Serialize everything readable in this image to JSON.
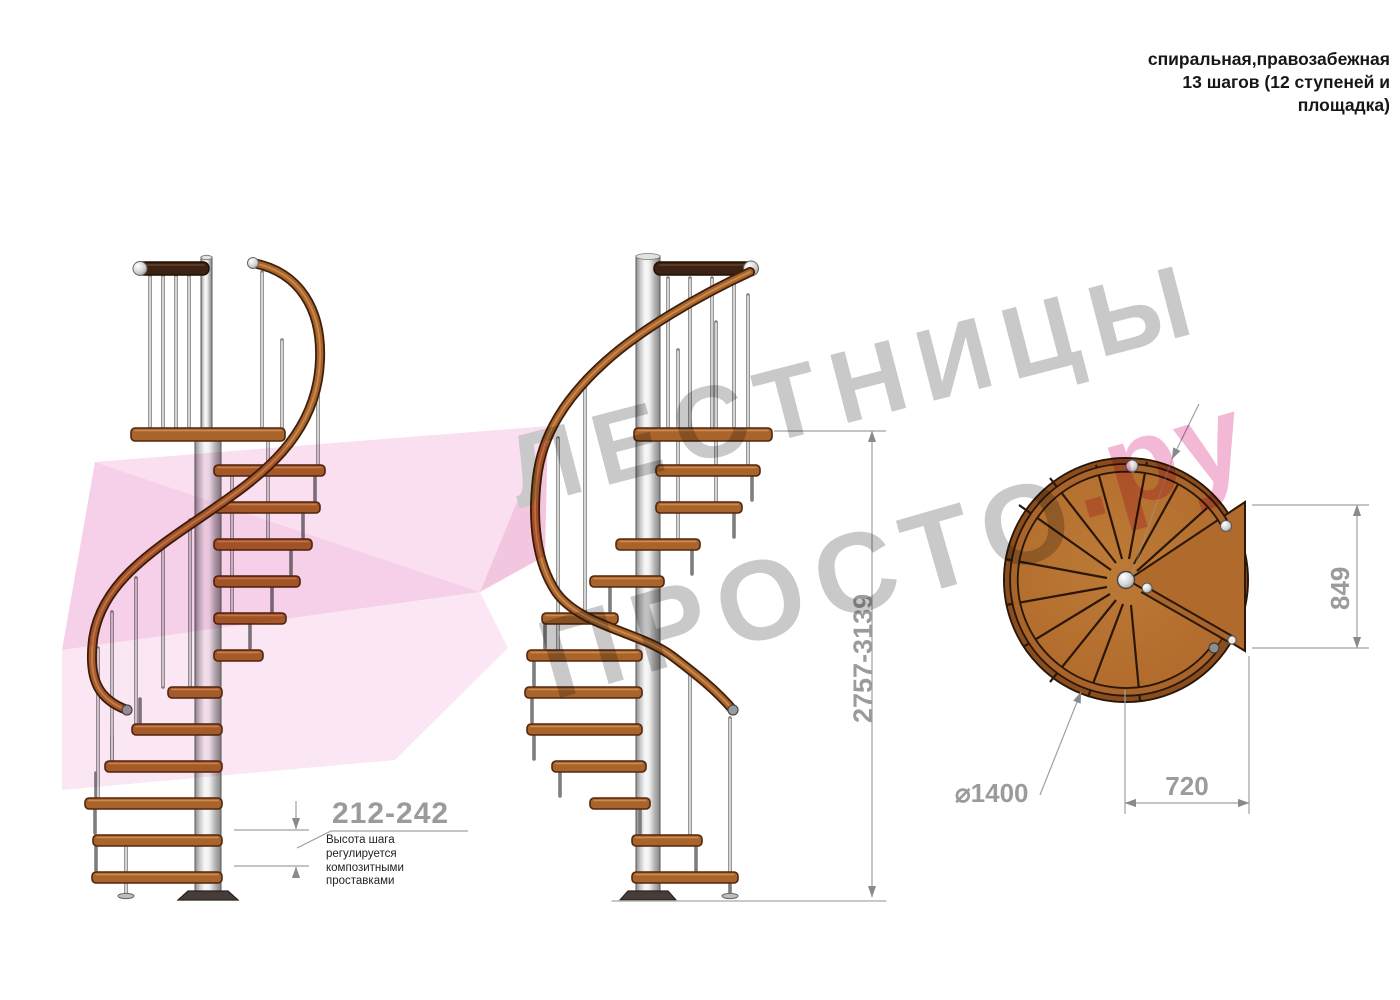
{
  "header": {
    "text": "спиральная,правозабежная\n13 шагов (12 ступеней и\nплощадка)"
  },
  "dimensions": {
    "step_height": "212-242",
    "step_height_note": "Высота шага\nрегулируется\nкомпозитными\nпроставками",
    "total_height": "2757-3139",
    "plan_depth": "849",
    "plan_width": "720",
    "plan_diameter": "⌀1400"
  },
  "watermark": {
    "brand_line1": "ЛЕСТНИЦЫ",
    "brand_line2": "ПРОСТО",
    "brand_suffix": ".ру"
  },
  "colors": {
    "wood": "#a8642a",
    "wood_dark_edge": "#50260f",
    "pole_metal": "#c9c9c9",
    "dimension_gray": "#9b9b9b",
    "watermark_gray": "#c9c9c9",
    "watermark_pink": "#f2b8d5",
    "ribbon_pink": "#f6d2e9"
  }
}
